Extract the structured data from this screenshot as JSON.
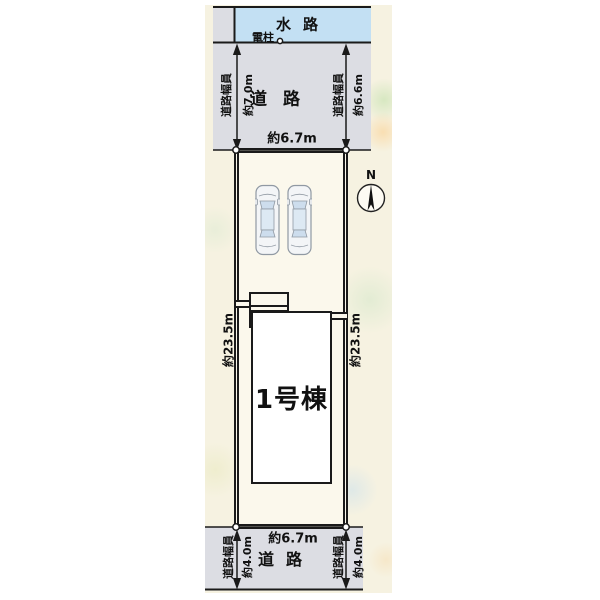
{
  "colors": {
    "water": "#c3e0f3",
    "road": "#dcdde3",
    "background_strip": "#f6f2e1",
    "lot_fill": "#fbf8ec",
    "building_fill": "#ffffff",
    "line": "#1a1a1a"
  },
  "plan": {
    "waterway": {
      "label": "水路"
    },
    "utility_pole": {
      "label": "電柱"
    },
    "compass": {
      "north_label": "N"
    },
    "road_top": {
      "label": "道路",
      "left_width": {
        "caption": "道路幅員",
        "value": "約7.0m"
      },
      "right_width": {
        "caption": "道路幅員",
        "value": "約6.6m"
      },
      "frontage": {
        "value": "約6.7m"
      }
    },
    "lot": {
      "left_depth": "約23.5m",
      "right_depth": "約23.5m",
      "building": {
        "label": "1号棟"
      }
    },
    "road_bottom": {
      "label": "道路",
      "left_width": {
        "caption": "道路幅員",
        "value": "約4.0m"
      },
      "right_width": {
        "caption": "道路幅員",
        "value": "約4.0m"
      },
      "frontage": {
        "value": "約6.7m"
      }
    }
  }
}
